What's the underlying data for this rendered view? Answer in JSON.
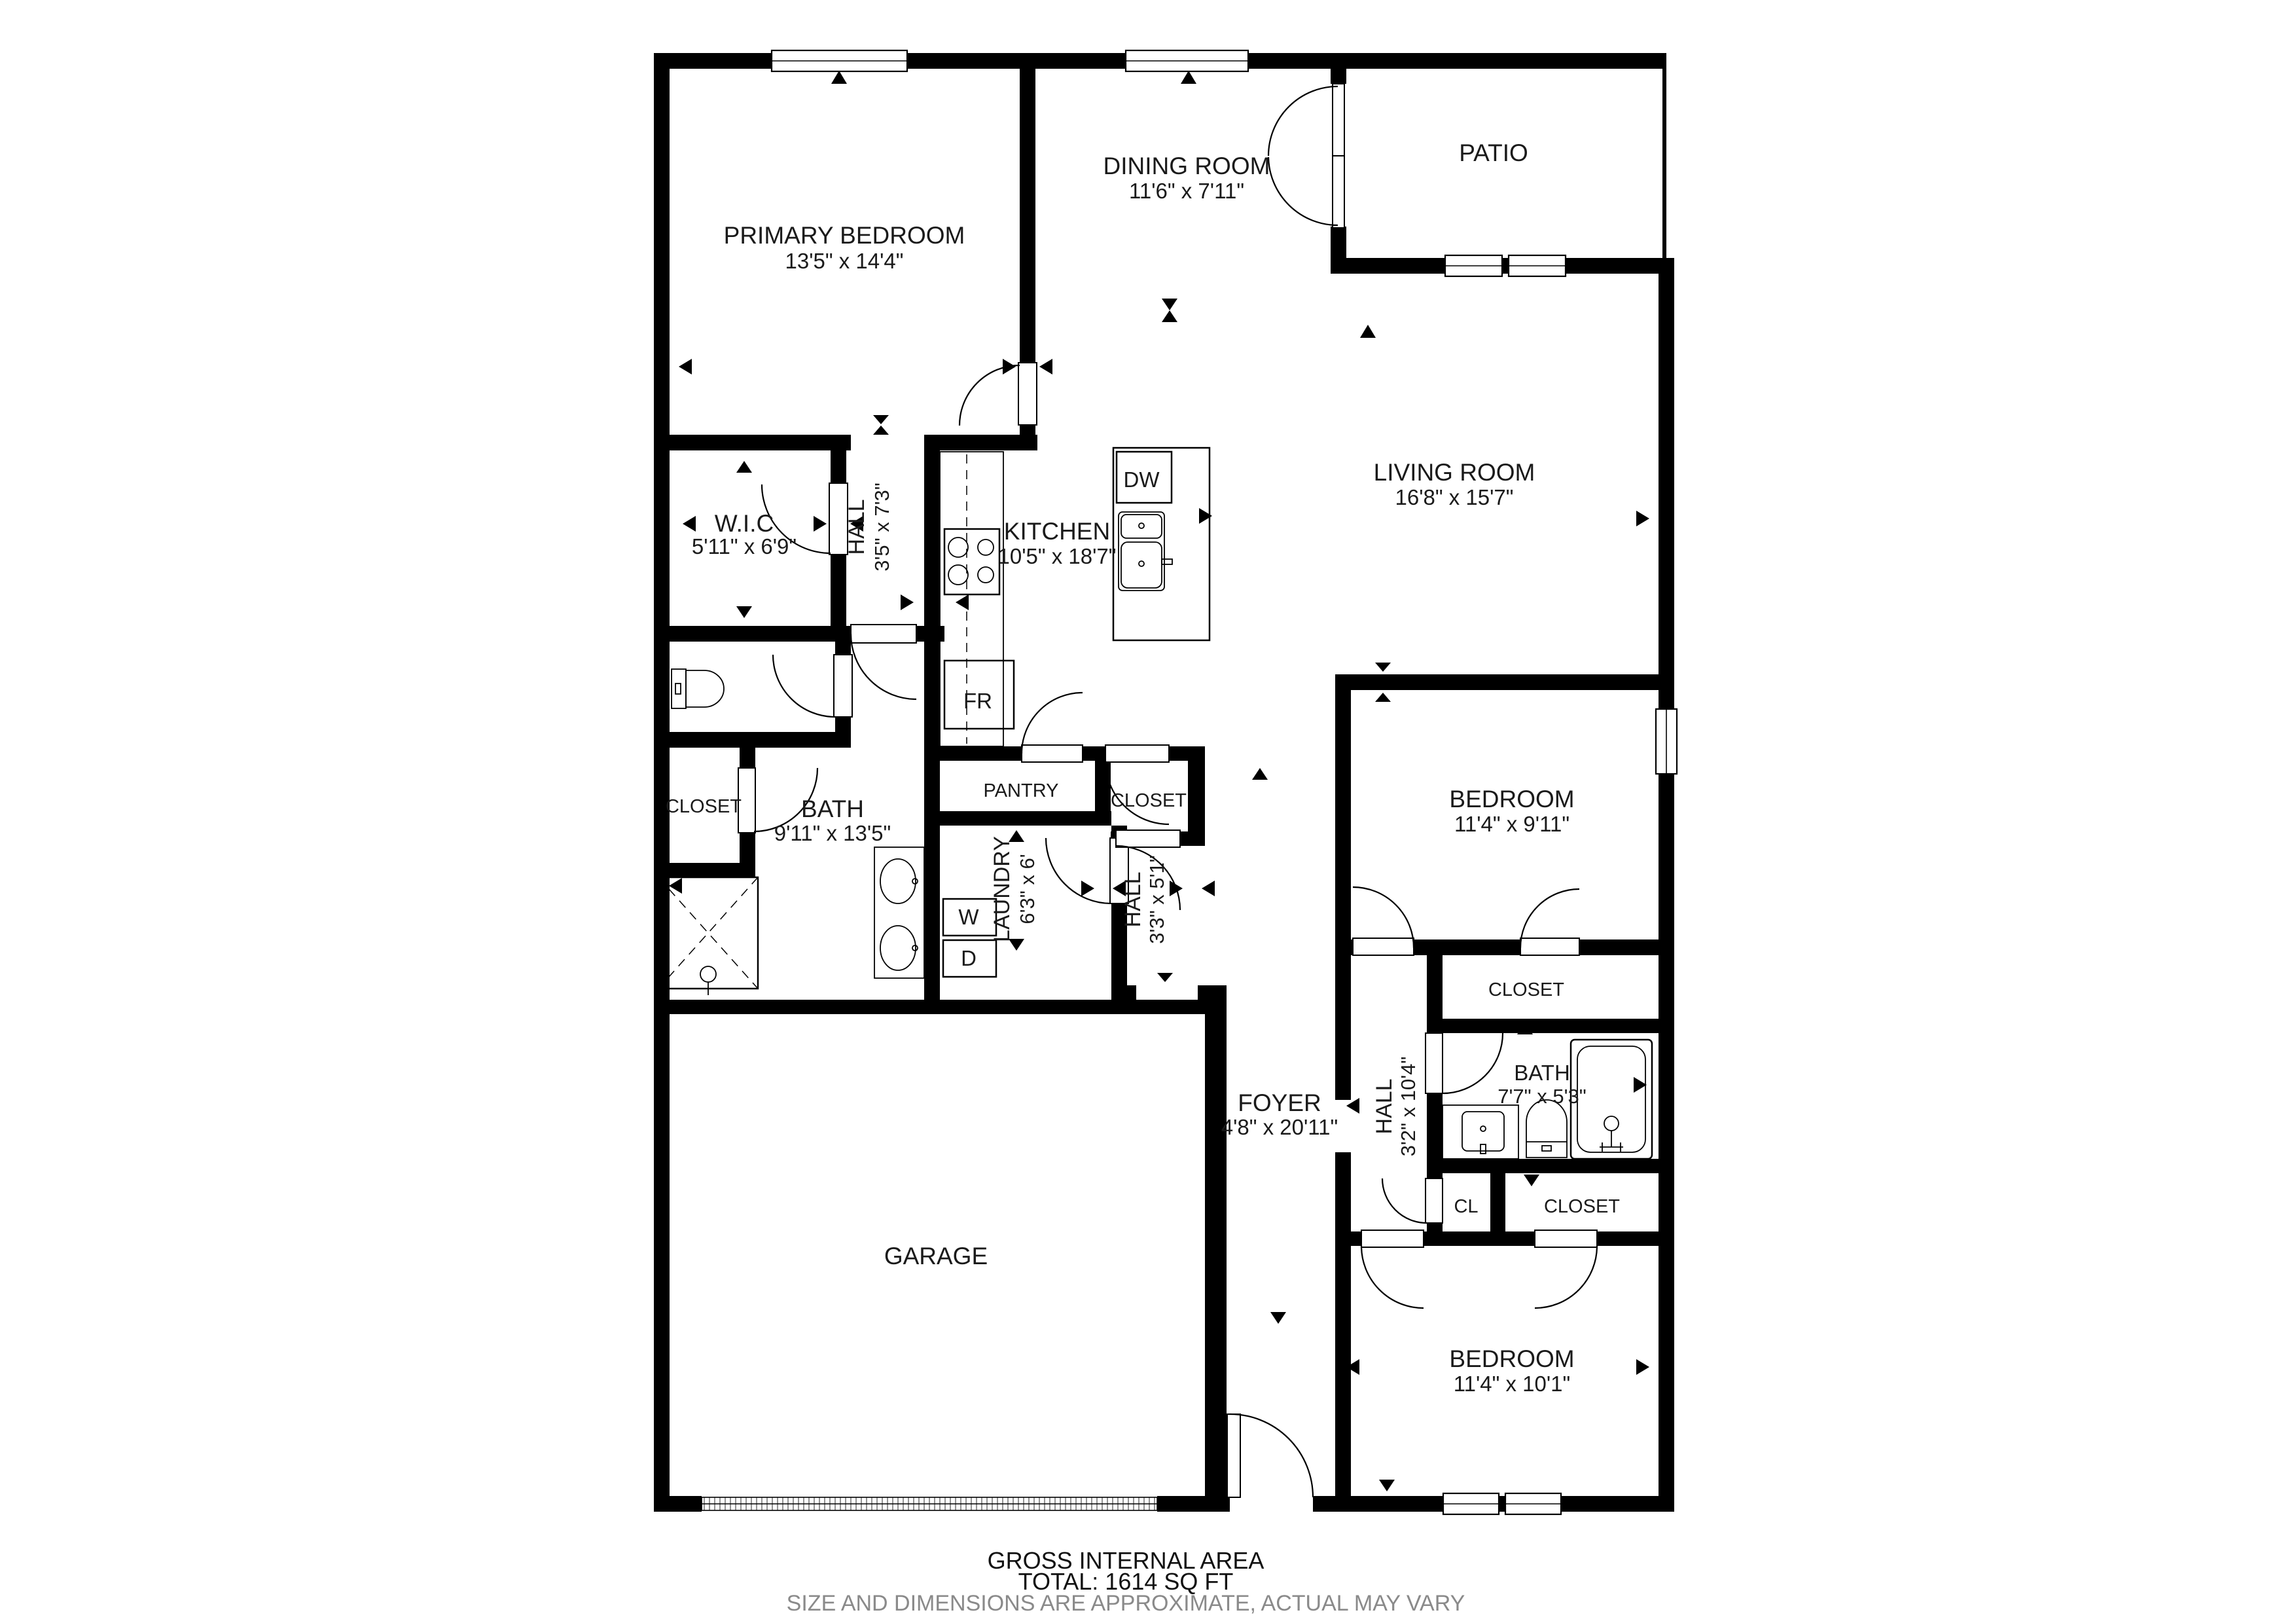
{
  "colors": {
    "walls": "#000000",
    "footer_note": "#8a8a8a"
  },
  "rooms": {
    "primary_bedroom": {
      "name": "PRIMARY BEDROOM",
      "dims": "13'5\" x 14'4\""
    },
    "dining_room": {
      "name": "DINING ROOM",
      "dims": "11'6\" x 7'11\""
    },
    "patio": {
      "name": "PATIO"
    },
    "living_room": {
      "name": "LIVING ROOM",
      "dims": "16'8\" x 15'7\""
    },
    "wic": {
      "name": "W.I.C",
      "dims": "5'11\" x 6'9\""
    },
    "hall_primary": {
      "name": "HALL",
      "dims": "3'5\" x 7'3\""
    },
    "kitchen": {
      "name": "KITCHEN",
      "dims": "10'5\" x 18'7\""
    },
    "bath_primary": {
      "name": "BATH",
      "dims": "9'11\" x 13'5\""
    },
    "closet_primary": {
      "name": "CLOSET"
    },
    "pantry": {
      "name": "PANTRY"
    },
    "closet_hall": {
      "name": "CLOSET"
    },
    "laundry": {
      "name": "LAUNDRY",
      "dims": "6'3\" x 6'"
    },
    "hall_laundry": {
      "name": "HALL",
      "dims": "3'3\" x 5'1\""
    },
    "bedroom_top": {
      "name": "BEDROOM",
      "dims": "11'4\" x 9'11\""
    },
    "closet_top": {
      "name": "CLOSET"
    },
    "bath_shared": {
      "name": "BATH",
      "dims": "7'7\" x 5'3\""
    },
    "hall_bedrooms": {
      "name": "HALL",
      "dims": "3'2\" x 10'4\""
    },
    "closet_cl": {
      "name": "CL"
    },
    "closet_bottom": {
      "name": "CLOSET"
    },
    "foyer": {
      "name": "FOYER",
      "dims": "4'8\" x 20'11\""
    },
    "garage": {
      "name": "GARAGE"
    },
    "bedroom_bottom": {
      "name": "BEDROOM",
      "dims": "11'4\" x 10'1\""
    }
  },
  "appliances": {
    "dishwasher": "DW",
    "fridge": "FR",
    "washer": "W",
    "dryer": "D"
  },
  "footer": {
    "line1": "GROSS INTERNAL AREA",
    "line2": "TOTAL: 1614 SQ FT",
    "line3": "SIZE AND DIMENSIONS ARE APPROXIMATE, ACTUAL MAY VARY"
  }
}
